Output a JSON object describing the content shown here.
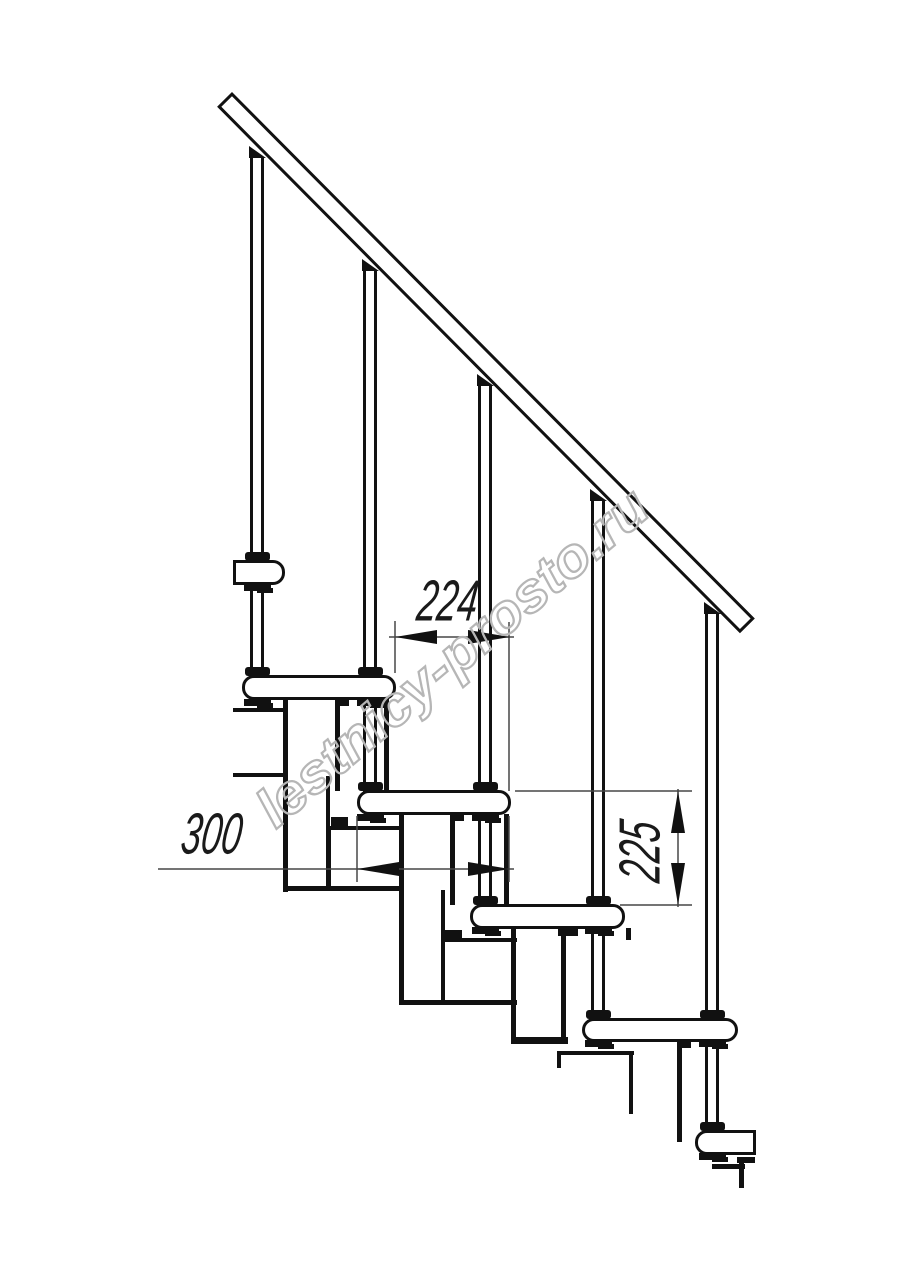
{
  "document": {
    "type": "technical line drawing",
    "subject": "modular staircase side elevation fragment",
    "background": "#ffffff"
  },
  "dimensions": {
    "run": {
      "value": "224",
      "orientation": "horizontal"
    },
    "depth": {
      "value": "300",
      "orientation": "horizontal"
    },
    "rise": {
      "value": "225",
      "orientation": "vertical"
    }
  },
  "watermark": {
    "text": "lestnicy-prosto.ru",
    "color": "#b6b6b6"
  },
  "colors": {
    "line": "#111111",
    "dim_line": "#474747",
    "text": "#1a1a1a",
    "background": "#ffffff"
  }
}
